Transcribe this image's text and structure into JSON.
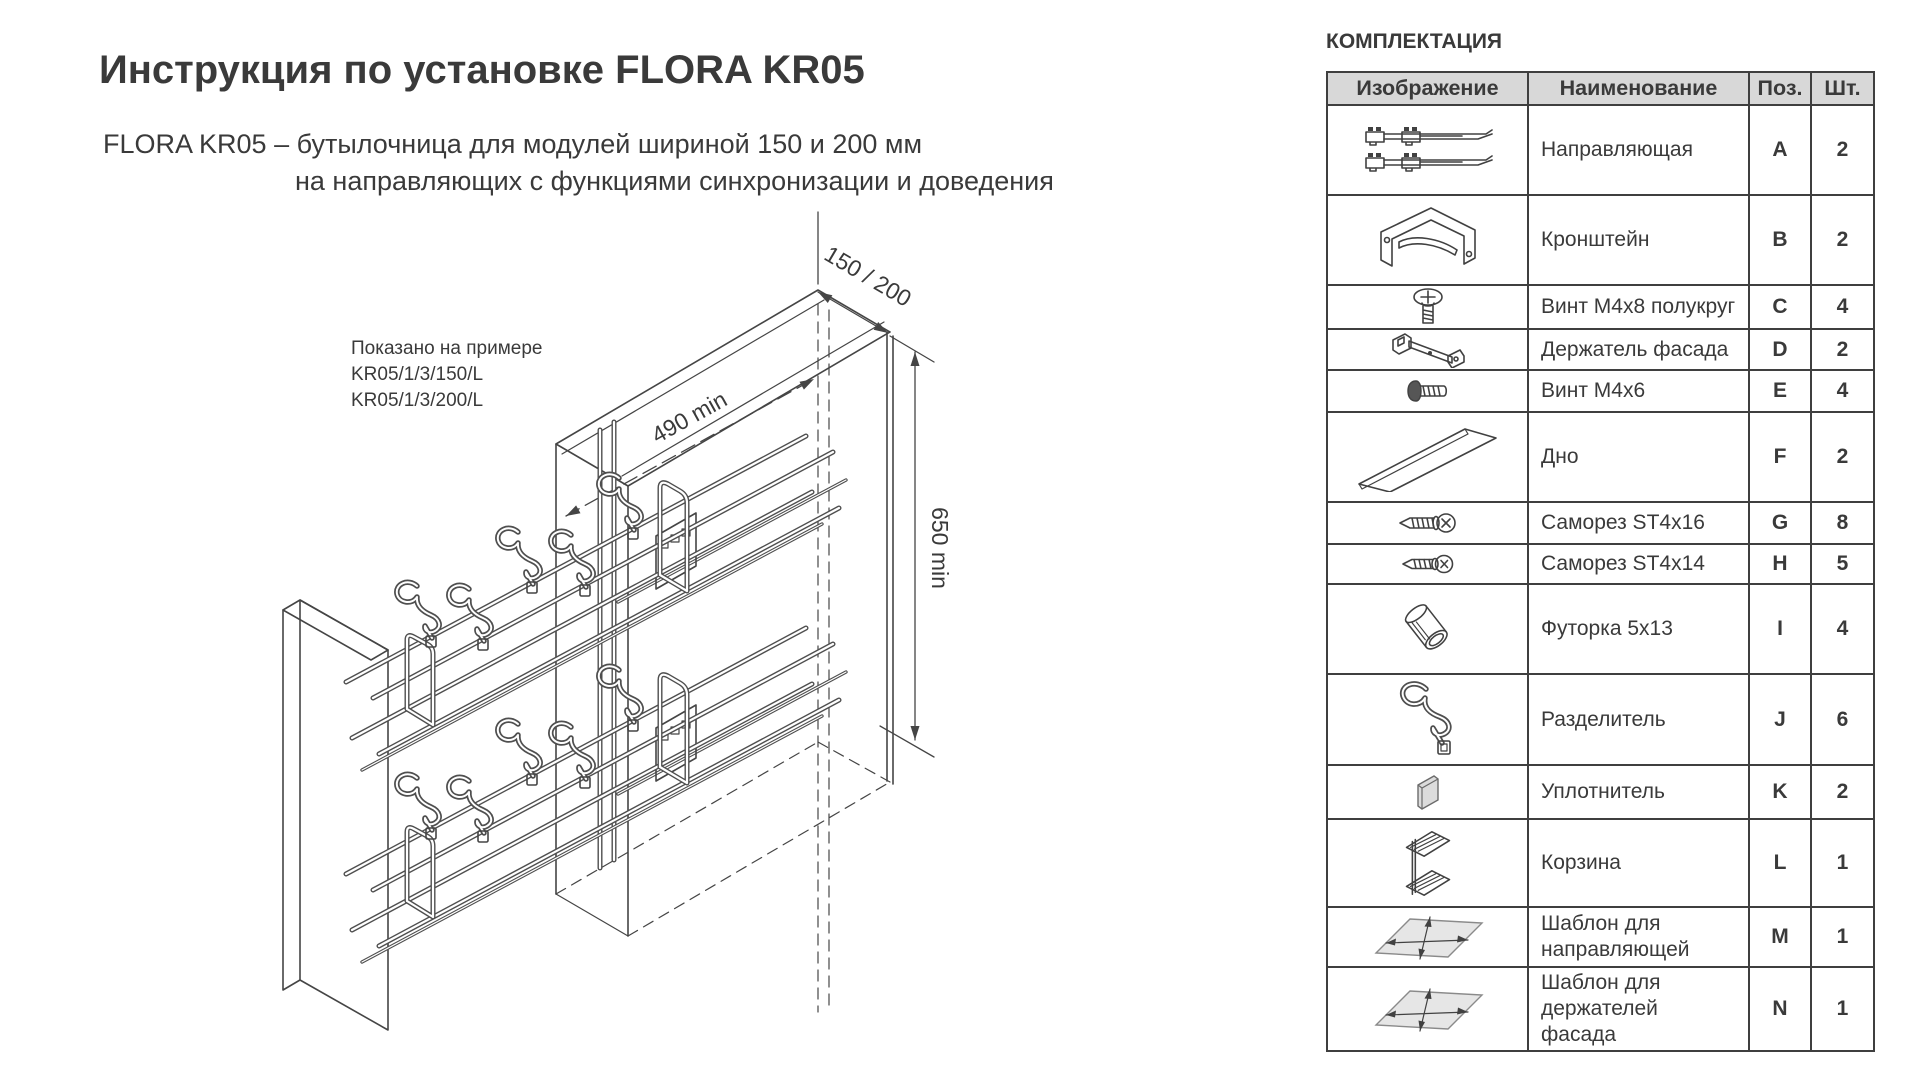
{
  "page": {
    "title": "Инструкция по установке FLORA KR05",
    "subtitle_line1": "FLORA  KR05 – бутылочница для модулей шириной 150 и 200 мм",
    "subtitle_line2": "на направляющих с функциями синхронизации и доведения"
  },
  "drawing": {
    "note_line1": "Показано на примере",
    "note_line2": "KR05/1/3/150/L",
    "note_line3": "KR05/1/3/200/L",
    "dim_width": "150 / 200",
    "dim_depth": "490 min",
    "dim_height": "650 min"
  },
  "parts_table": {
    "title": "КОМПЛЕКТАЦИЯ",
    "headers": {
      "image": "Изображение",
      "name": "Наименование",
      "pos": "Поз.",
      "qty": "Шт."
    },
    "rows": [
      {
        "icon": "rails-pair",
        "name": "Направляющая",
        "pos": "A",
        "qty": "2"
      },
      {
        "icon": "bracket",
        "name": "Кронштейн",
        "pos": "B",
        "qty": "2"
      },
      {
        "icon": "screw-round",
        "name": "Винт M4x8 полукруг",
        "pos": "C",
        "qty": "4"
      },
      {
        "icon": "facade-holder",
        "name": "Держатель фасада",
        "pos": "D",
        "qty": "2"
      },
      {
        "icon": "screw-m4x6",
        "name": "Винт M4x6",
        "pos": "E",
        "qty": "4"
      },
      {
        "icon": "bottom-strip",
        "name": "Дно",
        "pos": "F",
        "qty": "2"
      },
      {
        "icon": "screw-st4x16",
        "name": "Саморез ST4x16",
        "pos": "G",
        "qty": "8"
      },
      {
        "icon": "screw-st4x14",
        "name": "Саморез ST4x14",
        "pos": "H",
        "qty": "5"
      },
      {
        "icon": "sleeve",
        "name": "Футорка 5x13",
        "pos": "I",
        "qty": "4"
      },
      {
        "icon": "divider",
        "name": "Разделитель",
        "pos": "J",
        "qty": "6"
      },
      {
        "icon": "seal",
        "name": "Уплотнитель",
        "pos": "K",
        "qty": "2"
      },
      {
        "icon": "basket",
        "name": "Корзина",
        "pos": "L",
        "qty": "1"
      },
      {
        "icon": "template-rails",
        "name": "Шаблон для направляющей",
        "pos": "M",
        "qty": "1"
      },
      {
        "icon": "template-facade",
        "name": "Шаблон для держателей фасада",
        "pos": "N",
        "qty": "1"
      }
    ]
  },
  "colors": {
    "text": "#3a3a3a",
    "line": "#454545",
    "table_border": "#3f3f3f",
    "header_bg": "#d8d8d8",
    "template_fill": "#e6e6e6"
  }
}
